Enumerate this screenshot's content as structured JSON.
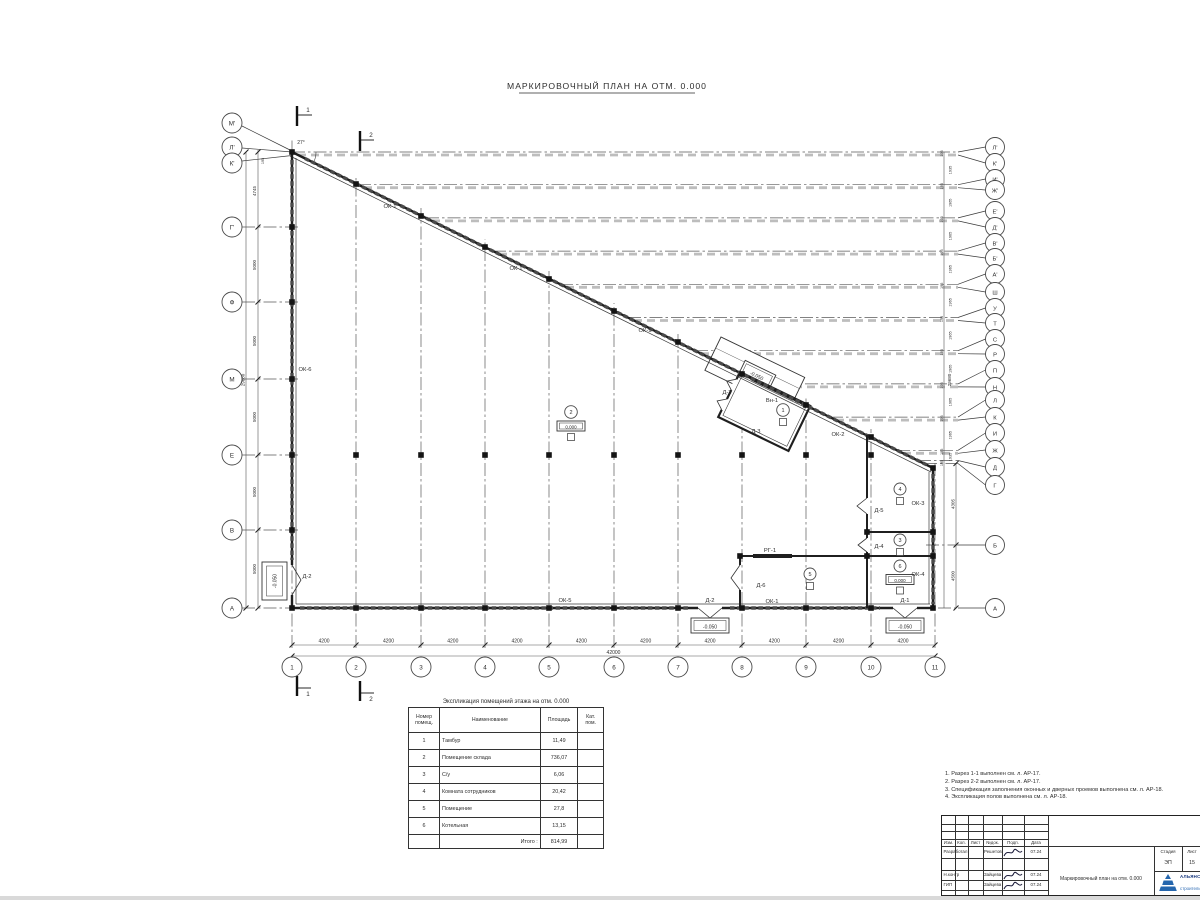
{
  "title": "МАРКИРОВОЧНЫЙ ПЛАН НА ОТМ. 0.000",
  "colors": {
    "logo_blue": "#2566ad",
    "logo_text": "#16367d",
    "line": "#2d2d2d"
  },
  "section_marks": {
    "s1": "1",
    "s2": "2"
  },
  "angle": "27°",
  "axes": {
    "bottom": {
      "labels": [
        "1",
        "2",
        "3",
        "4",
        "5",
        "6",
        "7",
        "8",
        "9",
        "10",
        "11"
      ],
      "dim": "4200",
      "total": "42000"
    },
    "left": {
      "labels": [
        "М'",
        "Л'",
        "К'",
        "Г'",
        "Ф",
        "М",
        "Е",
        "В",
        "А"
      ],
      "dims": [
        "195",
        "4745",
        "5000",
        "5000",
        "5000",
        "5000",
        "5000"
      ],
      "total": "29680"
    },
    "right": {
      "labels": [
        "Л'",
        "К'",
        "И'",
        "Ж'",
        "Е'",
        "Д'",
        "В'",
        "Б'",
        "А'",
        "Ш",
        "У",
        "Т",
        "С",
        "Р",
        "П",
        "Н",
        "Л",
        "К",
        "И",
        "Ж",
        "Д",
        "Г",
        "Б",
        "А"
      ],
      "pair_dims": [
        "195",
        "1935",
        "195",
        "1965",
        "195",
        "1965",
        "195",
        "1965",
        "195",
        "1965",
        "195",
        "1965",
        "195",
        "1965",
        "195",
        "1965",
        "195",
        "1965",
        "195",
        "1935",
        "195"
      ],
      "lower_dims": [
        "4305",
        "4500"
      ],
      "total": "29680"
    }
  },
  "marks": {
    "ok1": "ОК-1",
    "ok2": "ОК-2",
    "ok3": "ОК-3",
    "ok4": "ОК-4",
    "ok5": "ОК-5",
    "ok6": "ОК-6",
    "d1": "Д-1",
    "d2": "Д-2",
    "d3": "Д-3",
    "d4": "Д-4",
    "d5": "Д-5",
    "d6": "Д-6",
    "vn1": "Вн-1",
    "rg1": "РГ-1"
  },
  "levels": {
    "zero": "0.000",
    "minus": "-0.050"
  },
  "room_numbers": [
    "1",
    "2",
    "3",
    "4",
    "5",
    "6"
  ],
  "table": {
    "title": "Экспликация помещений этажа на отм. 0.000",
    "headers": {
      "num": "Номер помещ.",
      "name": "Наименование",
      "area": "Площадь",
      "cat": "Кат. пом."
    },
    "rows": [
      [
        "1",
        "Тамбур",
        "11,49"
      ],
      [
        "2",
        "Помещение склада",
        "736,07"
      ],
      [
        "3",
        "С/у",
        "6,06"
      ],
      [
        "4",
        "Комната сотрудников",
        "20,42"
      ],
      [
        "5",
        "Помещение",
        "27,8"
      ],
      [
        "6",
        "Котельная",
        "13,15"
      ]
    ],
    "total_label": "Итого :",
    "total": "814,99"
  },
  "notes": [
    "1. Разрез 1-1 выполнен см. л. АР-17.",
    "2. Разрез 2-2 выполнен см. л. АР-17.",
    "3. Спецификация заполнения оконных и дверных проемов выполнена см. л. АР-18.",
    "4. Экспликация полов выполнена см. л. АР-18."
  ],
  "titleblock": {
    "cols": [
      "Изм.",
      "Кол.",
      "Лист",
      "№док.",
      "Подп.",
      "Дата"
    ],
    "rows": [
      {
        "role": "Разработал",
        "name": "Решетов",
        "date": "07.24"
      },
      {
        "role": "Н.контр",
        "name": "Зайцева",
        "date": "07.24"
      },
      {
        "role": "ГИП",
        "name": "Зайцева",
        "date": "07.24"
      }
    ],
    "doc_name": "Маркировочный план на отм. 0.000",
    "stage_label": "Стадия",
    "sheet_label": "Лист",
    "stage": "ЭП",
    "sheet": "15",
    "logo_text": "АЛЬЯНС",
    "logo_sub": "строительная компания"
  }
}
